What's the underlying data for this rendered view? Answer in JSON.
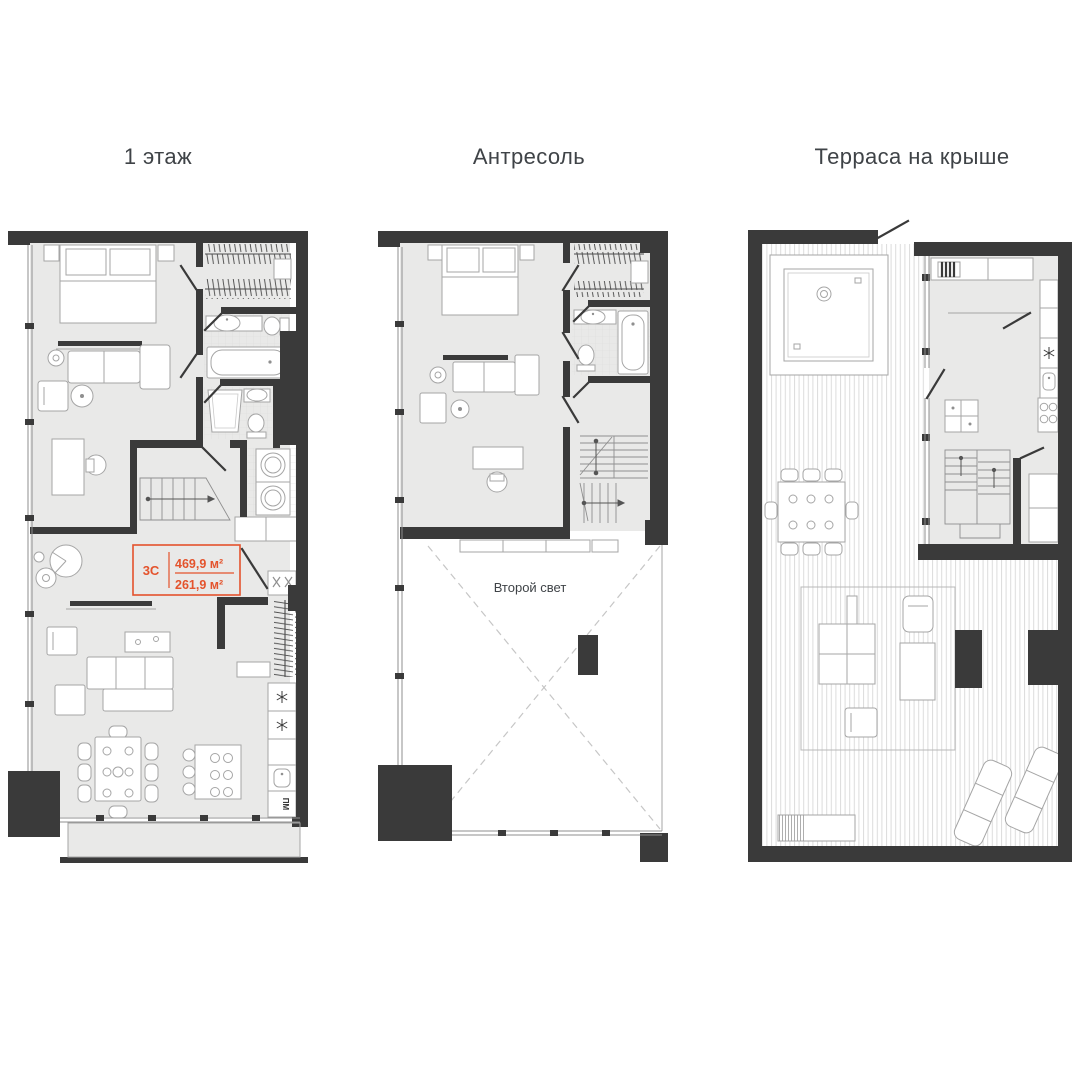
{
  "colors": {
    "wall": "#3a3a3a",
    "floor": "#e9e9e8",
    "accent": "#e4532c",
    "line": "#a5a5a5",
    "title_text": "#3f4347"
  },
  "plans": [
    {
      "title": "1 этаж",
      "unit_label": {
        "code": "3C",
        "area_total": "469,9 м²",
        "area_secondary": "261,9 м²"
      },
      "appliance_labels": {
        "dishwasher": "ПМ"
      }
    },
    {
      "title": "Антресоль",
      "void_label": "Второй свет"
    },
    {
      "title": "Терраса на крыше"
    }
  ]
}
